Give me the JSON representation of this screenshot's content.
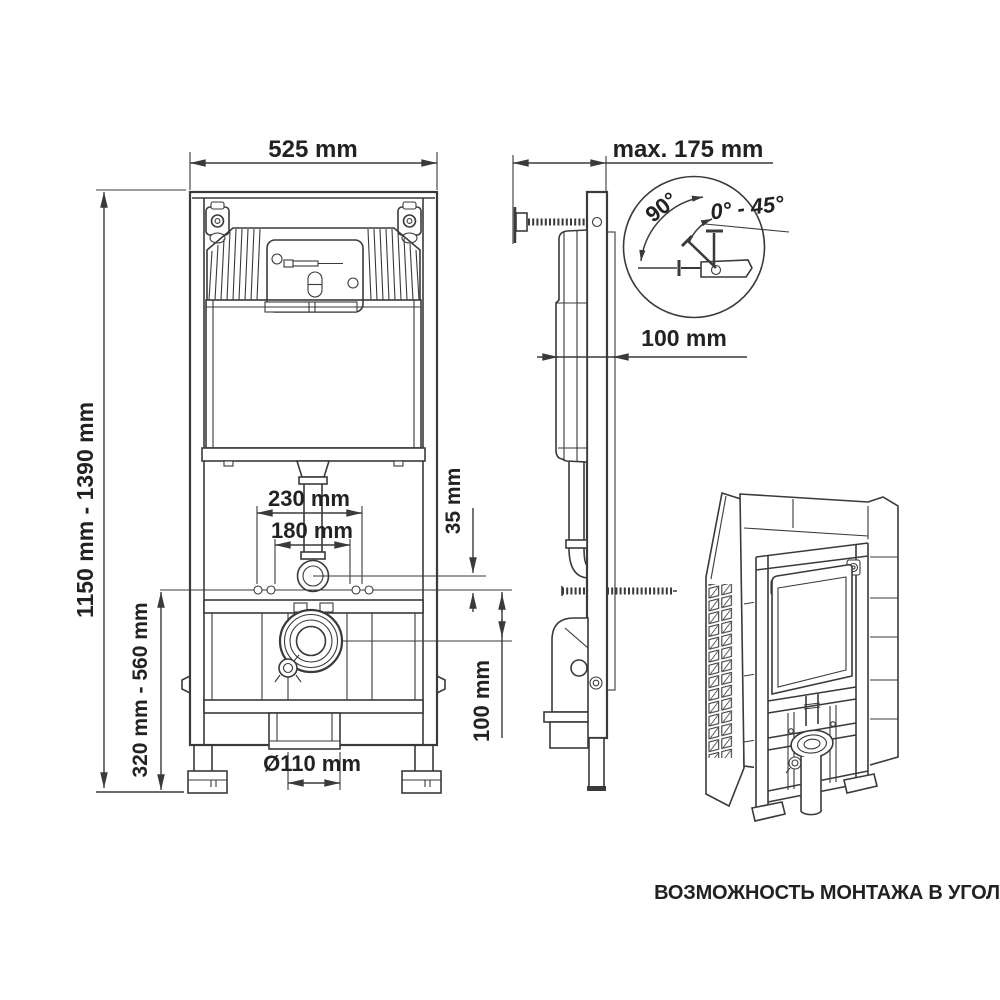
{
  "page": {
    "background": "#ffffff",
    "line_color": "#3a3a3a",
    "text_color": "#222222"
  },
  "front_view": {
    "width_label": "525 mm",
    "height_label": "1150 mm - 1390 mm",
    "base_height_label": "320 mm - 560 mm",
    "stud_spacing_wide_label": "230 mm",
    "stud_spacing_narrow_label": "180 mm",
    "flush_pipe_offset_label": "35 mm",
    "drain_offset_label": "100 mm",
    "drain_diameter_label": "Ø110 mm"
  },
  "side_view": {
    "max_depth_label": "max. 175 mm",
    "frame_depth_label": "100 mm"
  },
  "rotation_detail": {
    "angle_90_label": "90°",
    "angle_range_label": "0° - 45°"
  },
  "corner_view": {
    "caption": "ВОЗМОЖНОСТЬ МОНТАЖА В УГОЛ"
  }
}
